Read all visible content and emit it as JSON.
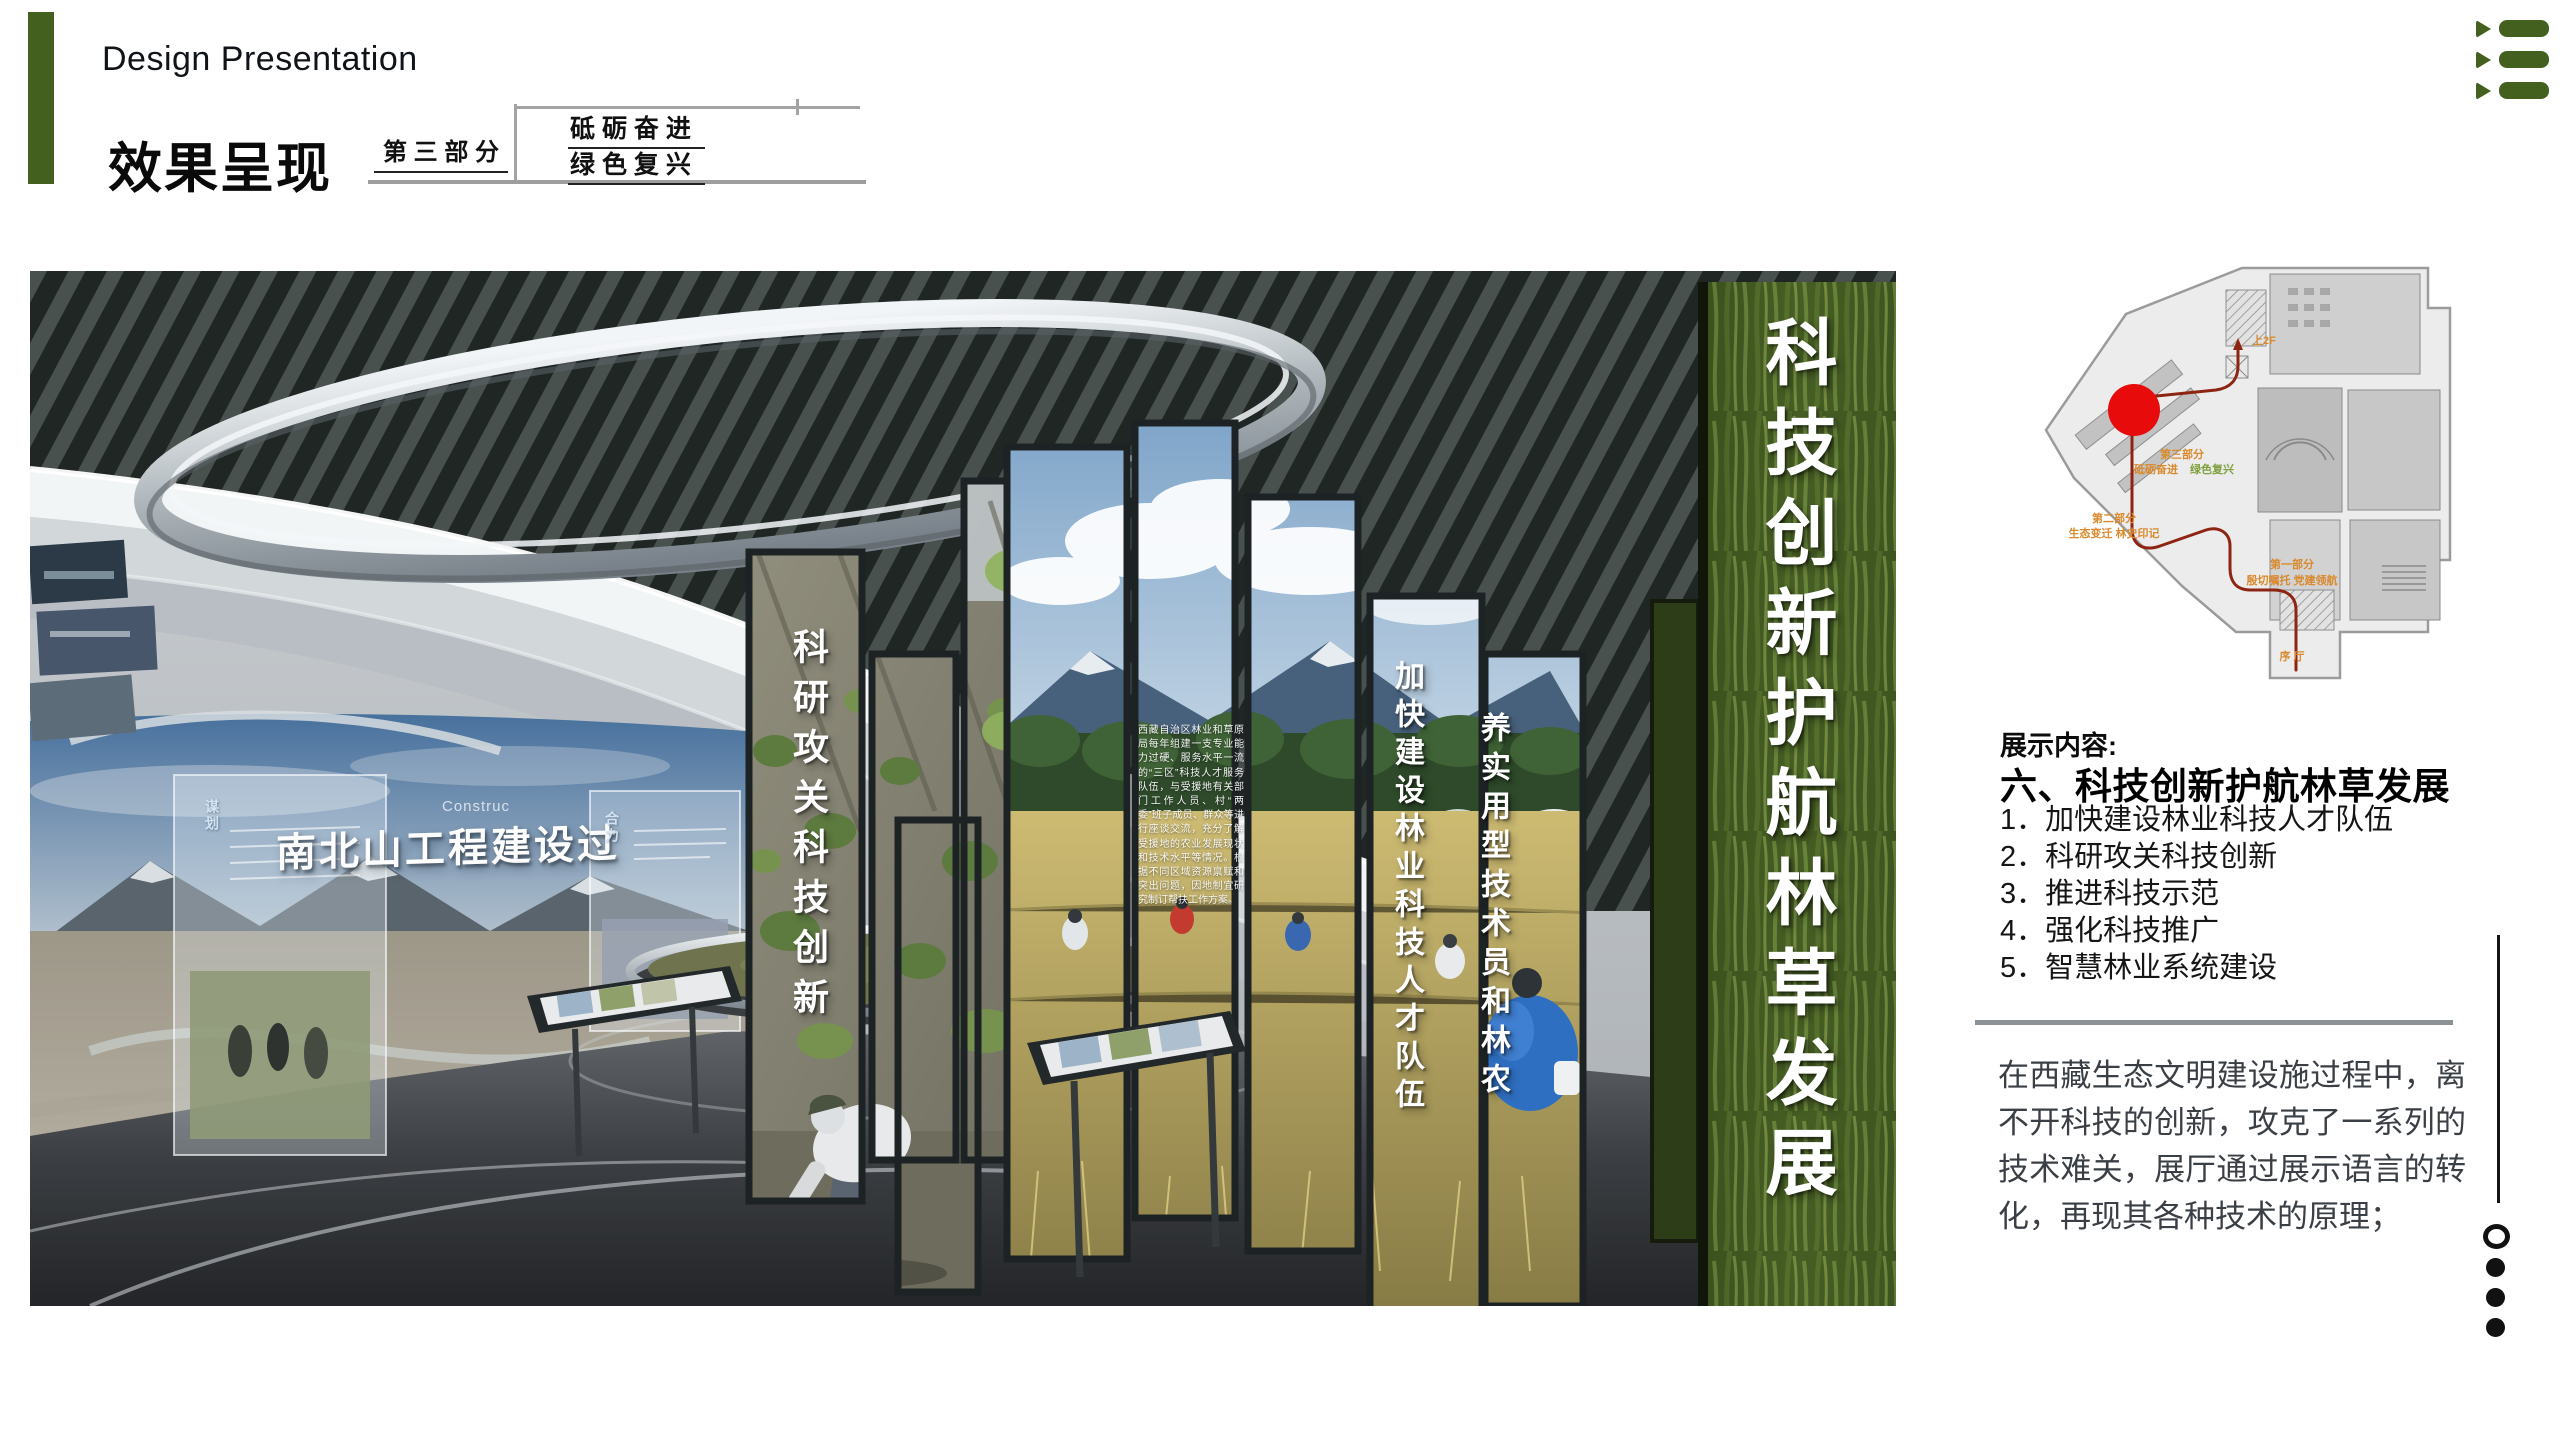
{
  "header": {
    "en_title": "Design Presentation",
    "cn_title": "效果呈现",
    "part_label": "第 三 部 分",
    "theme_line1": "砥 砺 奋 进",
    "theme_line2": "绿 色 复 兴",
    "accent_green": "#44601e"
  },
  "nav_icon": {
    "name": "list-icon",
    "color": "#44601e"
  },
  "render": {
    "screen_title": "南北山工程建设过",
    "screen_subtitle_fragment": "Construc",
    "glass_labels": [
      "谋划",
      "合力"
    ],
    "pillar_texts": {
      "main": "科技创新护航林草发展",
      "research": "科研攻关科技创新",
      "team": "加快建设林业科技人才队伍",
      "practical": "养实用型技术员和林农"
    },
    "panel_paragraph": "西藏自治区林业和草原局每年组建一支专业能力过硬、服务水平一流的“三区”科技人才服务队伍，与受援地有关部门工作人员、村“两委”班子成员、群众等进行座谈交流，充分了解受援地的农业发展现状和技术水平等情况。根据不同区域资源禀赋和突出问题，因地制宜研究制订帮扶工作方案。"
  },
  "plan": {
    "up2f": "上2F",
    "part3_line1": "第三部分",
    "part3_line2a": "砥砺奋进",
    "part3_line2b": "绿色复兴",
    "part2_line1": "第二部分",
    "part2_line2": "生态变迁 林史印记",
    "part1_line1": "第一部分",
    "part1_line2": "殷切嘱托 党建领航",
    "lobby": "序 厅",
    "marker_color": "#e80b0b",
    "route_color": "#8e2412",
    "label_color": "#d98a2e"
  },
  "content": {
    "header": "展示内容:",
    "title": "六、科技创新护航林草发展",
    "items": [
      "1．加快建设林业科技人才队伍",
      "2．科研攻关科技创新",
      "3．推进科技示范",
      "4．强化科技推广",
      "5．智慧林业系统建设"
    ],
    "paragraph": "在西藏生态文明建设施过程中，离不开科技的创新，攻克了一系列的技术难关，展厅通过展示语言的转化，再现其各种技术的原理；"
  },
  "pager": {
    "dots": [
      "open",
      "filled",
      "filled",
      "filled"
    ]
  }
}
